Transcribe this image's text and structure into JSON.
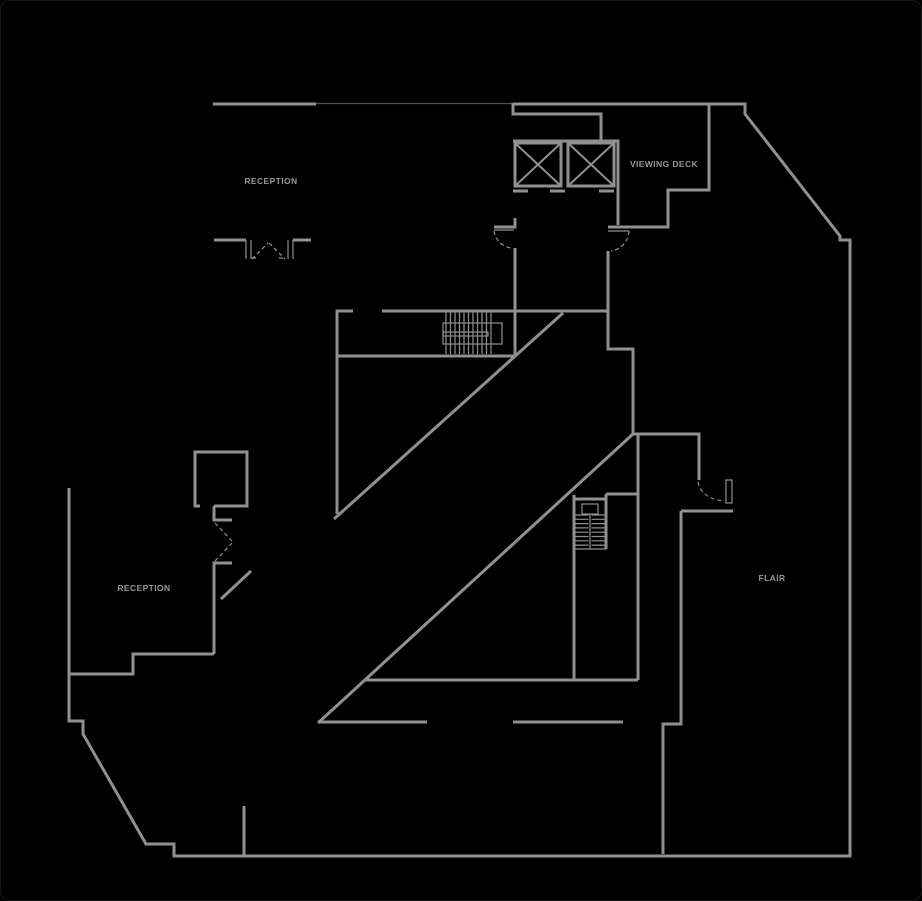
{
  "colors": {
    "background": "#000000",
    "wall": "#909090",
    "wall_dark": "#505050",
    "label": "#979797"
  },
  "labels": {
    "reception_upper": "RECEPTION",
    "viewing_deck": "VIEWING DECK",
    "reception_lower": "RECEPTION",
    "flair": "FLAIR"
  }
}
